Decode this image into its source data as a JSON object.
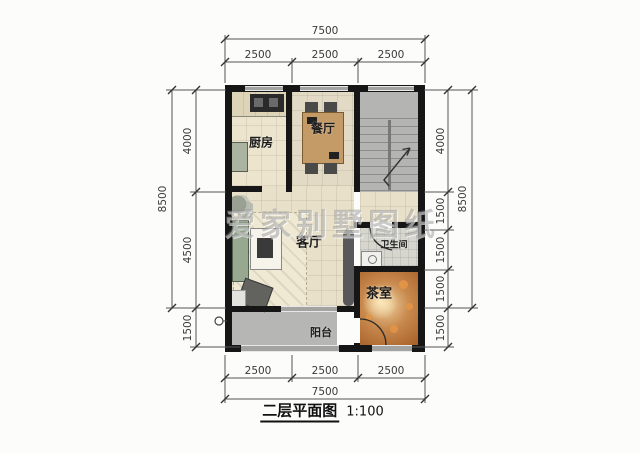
{
  "title": {
    "name": "二层平面图",
    "scale": "1:100"
  },
  "watermark": "爱家别墅图纸",
  "rooms": {
    "kitchen": {
      "label": "厨房"
    },
    "dining": {
      "label": "餐厅"
    },
    "living": {
      "label": "客厅"
    },
    "bathroom": {
      "label": "卫生间"
    },
    "tearoom": {
      "label": "茶室"
    },
    "balcony": {
      "label": "阳台"
    }
  },
  "dimensions": {
    "top": {
      "overall": "7500",
      "segments": [
        "2500",
        "2500",
        "2500"
      ]
    },
    "bottom": {
      "overall": "7500",
      "segments": [
        "2500",
        "2500",
        "2500"
      ]
    },
    "left": {
      "overall": "8500",
      "segments": [
        "4000",
        "4500",
        "1500"
      ]
    },
    "right": {
      "overall": "8500",
      "segments": [
        "4000",
        "1500",
        "1500",
        "1500",
        "1500"
      ]
    }
  },
  "colors": {
    "wall": "#161616",
    "window": "#a3a3a1",
    "tile_floor": "#e8e0c8",
    "stair_floor": "#b4b4b2",
    "tearoom_floor": "#b5763f",
    "balcony_floor": "#b6b6b4",
    "dim_text": "#3a3a3a"
  }
}
